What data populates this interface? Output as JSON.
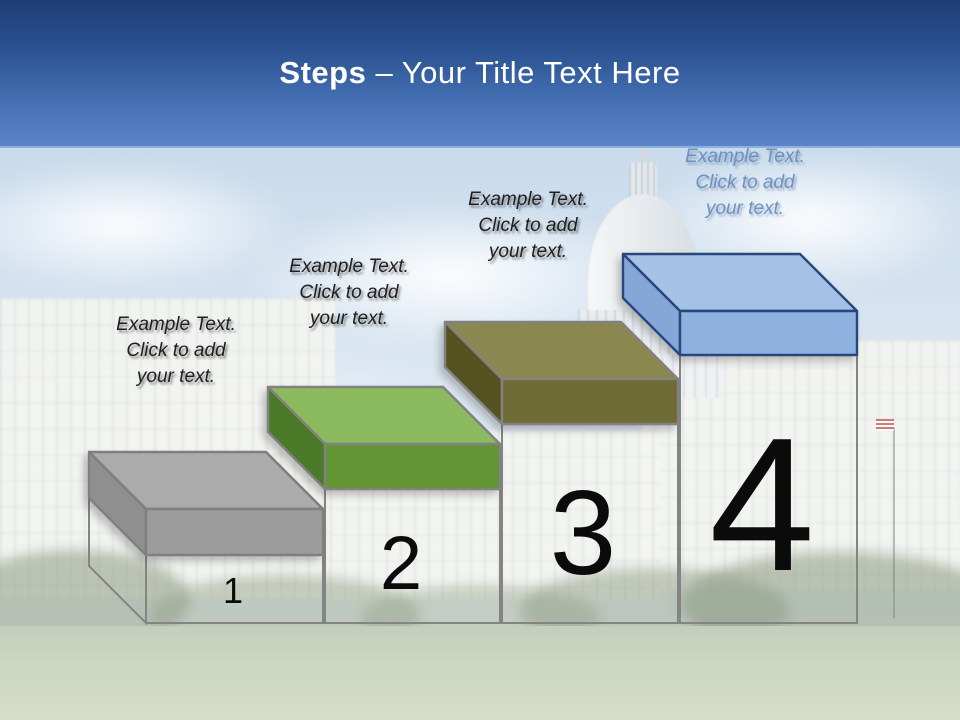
{
  "title": {
    "emphasis": "Steps",
    "rest": " – Your Title Text Here"
  },
  "banner": {
    "gradient_top_color": "#1d3e74",
    "gradient_bottom_color": "#5a86c8",
    "text_color": "#ffffff"
  },
  "background_photo": "us-capitol-building-washed-out",
  "steps": [
    {
      "number": "1",
      "caption": "Example Text.\nClick  to add\nyour text.",
      "caption_color": "#1f1f1f",
      "colors": {
        "top": "#ababab",
        "front": "#9c9c9c",
        "side": "#8f8f8f",
        "outline": "#7f7f7f"
      }
    },
    {
      "number": "2",
      "caption": "Example Text.\nClick  to add\nyour text.",
      "caption_color": "#1f1f1f",
      "colors": {
        "top": "#8cba5e",
        "front": "#649534",
        "side": "#4b7b27",
        "outline": "#828282"
      }
    },
    {
      "number": "3",
      "caption": "Example Text.\nClick  to add\nyour text.",
      "caption_color": "#1f1f1f",
      "colors": {
        "top": "#8b8750",
        "front": "#6f6b34",
        "side": "#565320",
        "outline": "#828282"
      }
    },
    {
      "number": "4",
      "caption": "Example Text.\nClick  to add\nyour text.",
      "caption_color": "#6389bd",
      "colors": {
        "top": "#a5c1e6",
        "front": "#8eb1e0",
        "side": "#84a7d7",
        "outline": "#26487b"
      }
    }
  ]
}
